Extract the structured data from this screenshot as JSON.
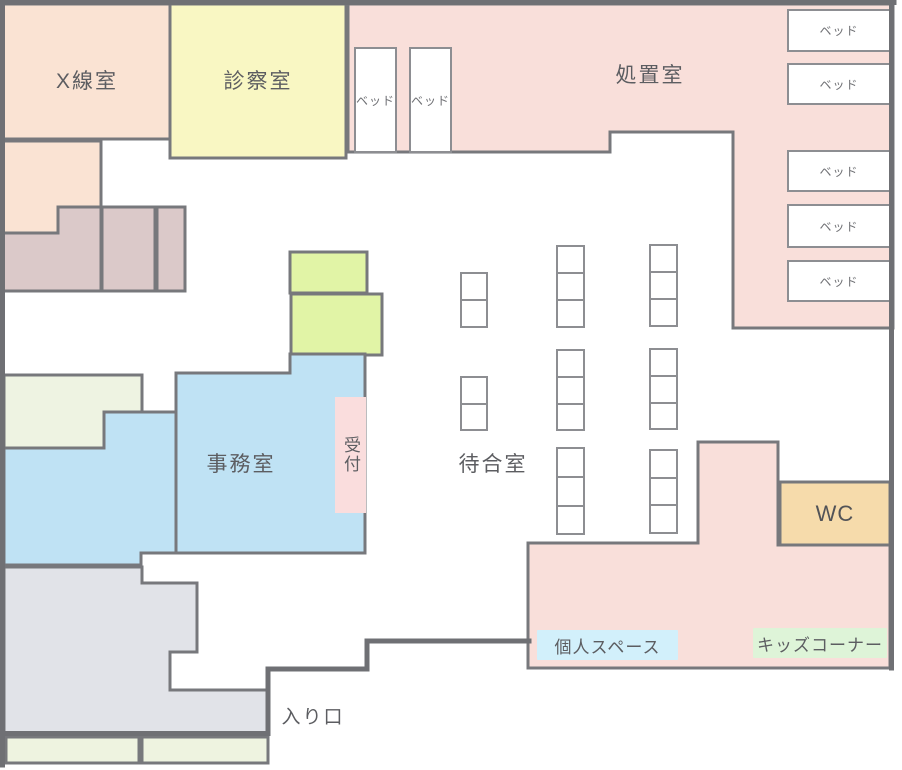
{
  "floorplan": {
    "rooms": {
      "xray": {
        "label": "X線室"
      },
      "exam": {
        "label": "診察室"
      },
      "treatment": {
        "label": "処置室"
      },
      "office": {
        "label": "事務室"
      },
      "reception": {
        "label": "受付"
      },
      "waiting": {
        "label": "待合室"
      },
      "wc": {
        "label": "WC"
      },
      "personal_space": {
        "label": "個人スペース"
      },
      "kids_corner": {
        "label": "キッズコーナー"
      },
      "entrance": {
        "label": "入り口"
      }
    },
    "furniture": {
      "bed": "ベッド"
    }
  },
  "colors": {
    "wall": "#6f7074",
    "room_border": "#77787c",
    "peach": "#fae3d3",
    "yellow": "#f9f7c3",
    "pink": "#f9dfda",
    "mauve": "#dbc9c9",
    "green": "#e1f4a6",
    "ivory": "#eef3e2",
    "blue": "#bfe2f4",
    "reception_pink": "#fadddd",
    "wc_orange": "#f6dbab",
    "corridor_gray": "#e1e3e8",
    "entrance_ivory": "#eef3e0",
    "personal_bg": "#d2f0fb",
    "kids_bg": "#def4d8",
    "furniture_white": "#ffffff"
  }
}
